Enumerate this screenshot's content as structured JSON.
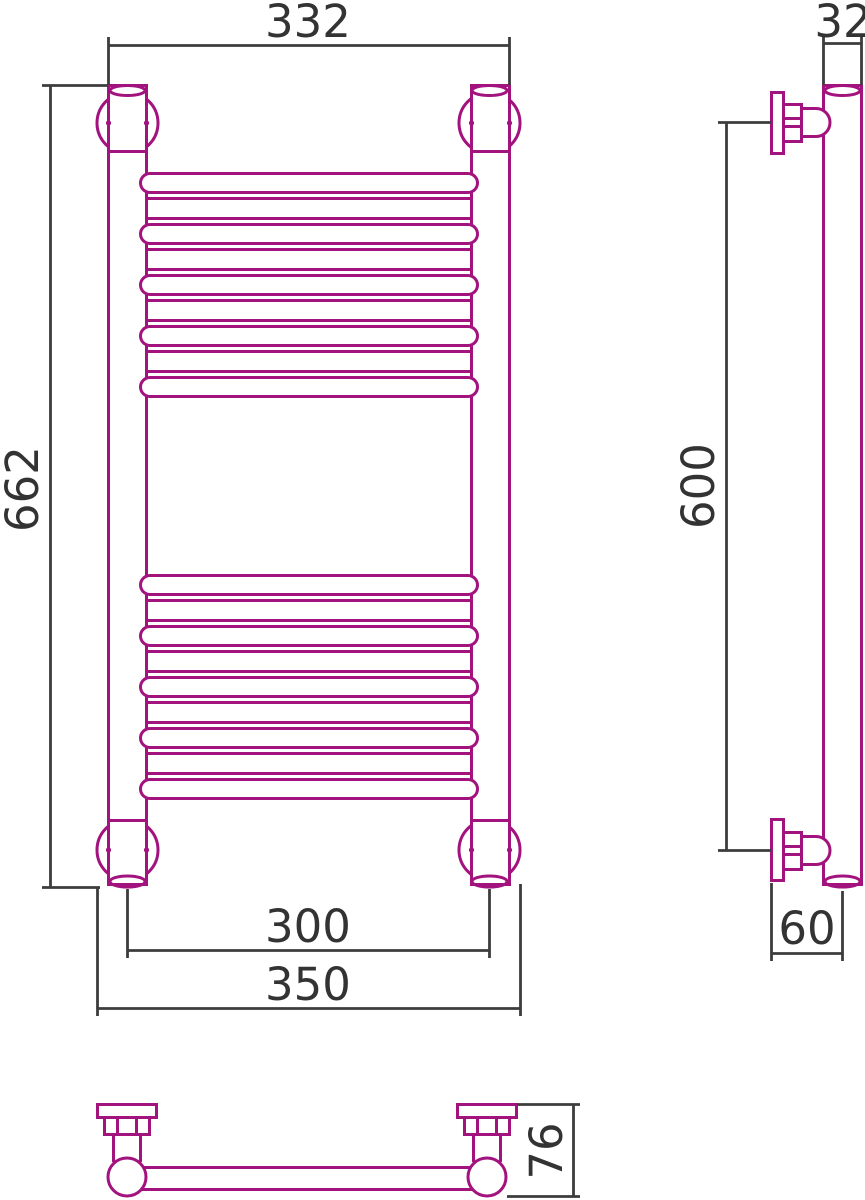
{
  "title": "Heated towel rail dimensional drawing",
  "colors": {
    "product": "#A2137E",
    "dim": "#3C3C3C",
    "text": "#333333",
    "bg": "#FFFFFF"
  },
  "views": {
    "front": {
      "name": "front view",
      "dims": {
        "top_width": "332",
        "total_height": "662",
        "axis_spacing": "300",
        "overall_width": "350"
      }
    },
    "side": {
      "name": "side view",
      "dims": {
        "pipe_diameter": "32",
        "bracket_spacing": "600",
        "wall_offset": "60"
      }
    },
    "bottom": {
      "name": "bottom view",
      "dims": {
        "depth": "76"
      }
    }
  }
}
